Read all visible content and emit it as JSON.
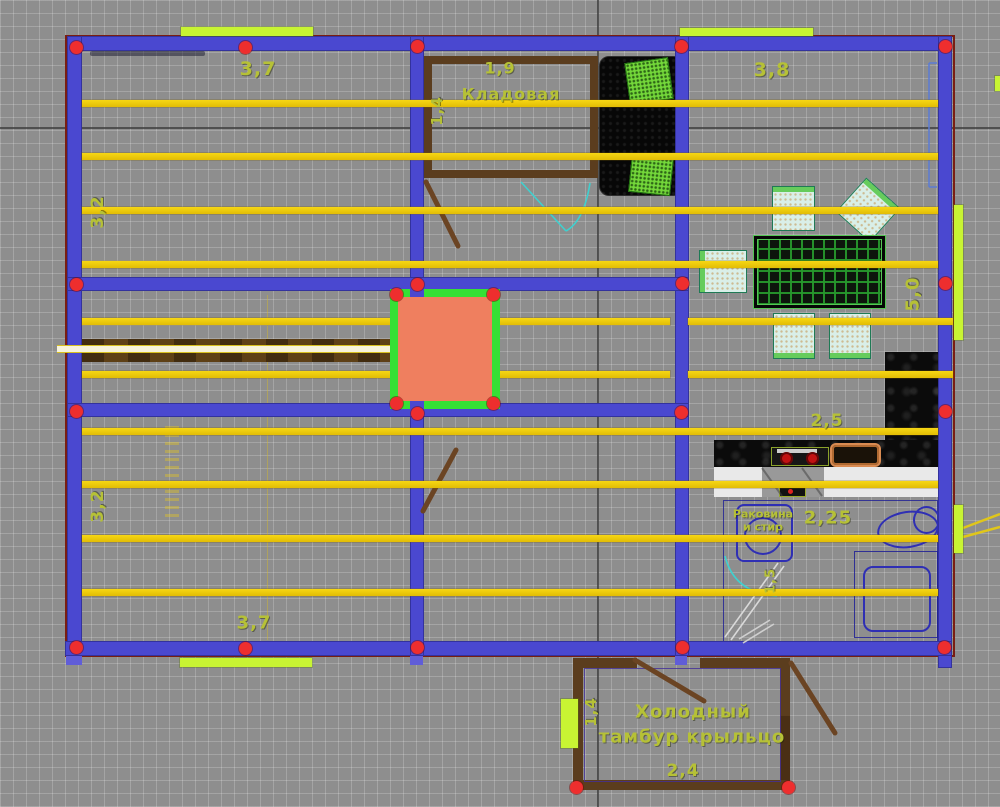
{
  "drawing": {
    "type": "cad-floor-plan",
    "colors": {
      "background": "#8e8e8e",
      "wall_blue": "#4a48d0",
      "joist_yellow": "#eec90d",
      "node_red": "#ee2e2e",
      "highlight_green": "#c8f433",
      "selection_green": "#35e035",
      "selection_fill_salmon": "#ef7f5f",
      "timber_brown": "#5b3d1e",
      "label_olive": "#b6c136",
      "fixture_blue": "#2f2fb4",
      "door_cyan": "#3fd0cf"
    }
  },
  "labels": {
    "dim_top_left": "3,7",
    "dim_top_right": "3,8",
    "dim_storage_width": "1,9",
    "room_storage": "Кладовая",
    "dim_storage_height": "1,4",
    "dim_left_top": "3,2",
    "dim_left_bottom": "3,2",
    "dim_right_height": "5,0",
    "dim_kitchen_top": "2,5",
    "dim_kitchen_mid": "2,25",
    "sink_line1": "Раковина",
    "sink_line2": "и стир",
    "dim_kitchen_door": "1,5",
    "dim_bottom": "3,7",
    "porch_line1": "Холодный",
    "porch_line2": "тамбур крыльцо",
    "dim_porch_width": "2,4",
    "dim_porch_height": "1,4"
  },
  "plan": {
    "joists": [
      [
        82,
        100,
        856
      ],
      [
        82,
        153,
        856
      ],
      [
        82,
        207,
        856
      ],
      [
        82,
        261,
        856
      ],
      [
        82,
        318,
        588
      ],
      [
        688,
        318,
        265
      ],
      [
        82,
        371,
        588
      ],
      [
        688,
        371,
        265
      ],
      [
        82,
        428,
        856
      ],
      [
        82,
        481,
        856
      ],
      [
        82,
        535,
        856
      ],
      [
        82,
        589,
        856
      ]
    ],
    "nodes": [
      [
        76,
        47
      ],
      [
        245,
        47
      ],
      [
        417,
        46
      ],
      [
        681,
        46
      ],
      [
        945,
        46
      ],
      [
        76,
        284
      ],
      [
        417,
        284
      ],
      [
        682,
        283
      ],
      [
        945,
        283
      ],
      [
        76,
        411
      ],
      [
        417,
        413
      ],
      [
        681,
        412
      ],
      [
        945,
        411
      ],
      [
        76,
        647
      ],
      [
        245,
        648
      ],
      [
        417,
        647
      ],
      [
        682,
        647
      ],
      [
        944,
        647
      ],
      [
        396,
        294
      ],
      [
        493,
        294
      ],
      [
        396,
        403
      ],
      [
        493,
        403
      ],
      [
        576,
        787
      ],
      [
        788,
        787
      ]
    ],
    "highlight_bars": [
      [
        181,
        27,
        132,
        9
      ],
      [
        680,
        28,
        133,
        8
      ],
      [
        954,
        205,
        9,
        135
      ],
      [
        954,
        505,
        9,
        48
      ],
      [
        180,
        658,
        132,
        9
      ],
      [
        561,
        699,
        17,
        49
      ],
      [
        995,
        76,
        5,
        15
      ]
    ]
  }
}
